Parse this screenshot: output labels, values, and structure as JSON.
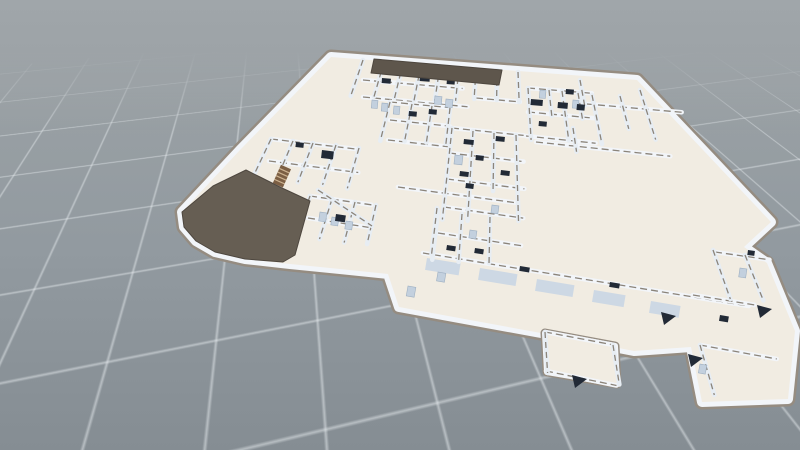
{
  "app": {
    "name": "3d-floorplan-viewer"
  },
  "viewport": {
    "width": 800,
    "height": 450
  },
  "palette": {
    "bg_top": "#a0a6aa",
    "bg_bottom": "#858d93",
    "grid_line": "rgba(232,237,240,0.5)",
    "floor": "#f1ece2",
    "wall_white": "#f2f5f9",
    "wall_white_v": "#e7edf3",
    "wall_cap": "#8b847a",
    "outline_cap": "#958c81",
    "roof_dark": "#665e53",
    "roof_strip": "#5e564c",
    "roof_edge": "#4e473f",
    "panel_recess": "#cdd8e4",
    "fixture": "#c3d0de",
    "fixture_edge": "#9fb0c2",
    "furniture": "#222a36",
    "stair": "#7c5f44",
    "stair_stripe": "#cdb391"
  },
  "scene": {
    "vp_u": [
      -1742,
      -99
    ],
    "vp_v": [
      502,
      -347
    ],
    "footprint": [
      [
        331,
        57
      ],
      [
        637,
        80
      ],
      [
        771,
        222
      ],
      [
        744,
        247
      ],
      [
        767,
        263
      ],
      [
        795,
        331
      ],
      [
        788,
        399
      ],
      [
        702,
        402
      ],
      [
        691,
        347
      ],
      [
        634,
        351
      ],
      [
        541,
        333
      ],
      [
        399,
        307
      ],
      [
        388,
        274
      ],
      [
        340,
        269
      ],
      [
        290,
        264
      ],
      [
        245,
        259
      ],
      [
        215,
        252
      ],
      [
        196,
        241
      ],
      [
        184,
        227
      ],
      [
        182,
        212
      ],
      [
        240,
        150
      ]
    ],
    "extra_floors": [
      [
        [
          545,
          333
        ],
        [
          615,
          346
        ],
        [
          617,
          384
        ],
        [
          547,
          372
        ]
      ]
    ],
    "roofs": [
      {
        "fill": "roof_dark",
        "points": [
          [
            182,
            212
          ],
          [
            184,
            227
          ],
          [
            196,
            241
          ],
          [
            215,
            252
          ],
          [
            245,
            259
          ],
          [
            283,
            262
          ],
          [
            295,
            255
          ],
          [
            310,
            201
          ],
          [
            282,
            188
          ],
          [
            260,
            177
          ],
          [
            246,
            170
          ],
          [
            213,
            186
          ]
        ]
      },
      {
        "fill": "roof_strip",
        "points": [
          [
            374,
            59
          ],
          [
            502,
            70
          ],
          [
            499,
            85
          ],
          [
            371,
            73
          ]
        ]
      }
    ],
    "walls_u": [
      [
        363,
        80,
        100
      ],
      [
        363,
        97,
        105
      ],
      [
        476,
        98,
        44
      ],
      [
        528,
        88,
        64
      ],
      [
        528,
        112,
        66
      ],
      [
        526,
        136,
        70
      ],
      [
        587,
        104,
        95
      ],
      [
        390,
        102,
        60
      ],
      [
        390,
        120,
        60
      ],
      [
        388,
        140,
        62
      ],
      [
        452,
        128,
        72
      ],
      [
        449,
        153,
        75
      ],
      [
        447,
        179,
        78
      ],
      [
        444,
        207,
        80
      ],
      [
        438,
        233,
        84
      ],
      [
        398,
        187,
        120
      ],
      [
        271,
        139,
        88
      ],
      [
        269,
        161,
        90
      ],
      [
        310,
        196,
        62
      ],
      [
        308,
        218,
        64
      ],
      [
        423,
        253,
        330
      ],
      [
        536,
        142,
        135
      ],
      [
        715,
        252,
        55
      ],
      [
        693,
        295,
        62
      ],
      [
        545,
        332,
        70
      ],
      [
        546,
        371,
        72
      ],
      [
        700,
        345,
        78
      ]
    ],
    "walls_v": [
      [
        363,
        60,
        38
      ],
      [
        384,
        62,
        36
      ],
      [
        403,
        63,
        36
      ],
      [
        421,
        65,
        36
      ],
      [
        440,
        66,
        35
      ],
      [
        459,
        68,
        33
      ],
      [
        476,
        69,
        30
      ],
      [
        497,
        70,
        30
      ],
      [
        518,
        72,
        30
      ],
      [
        528,
        88,
        52
      ],
      [
        549,
        90,
        26
      ],
      [
        562,
        91,
        50
      ],
      [
        578,
        93,
        26
      ],
      [
        592,
        95,
        50
      ],
      [
        580,
        80,
        26
      ],
      [
        620,
        96,
        34
      ],
      [
        640,
        90,
        52
      ],
      [
        573,
        128,
        24
      ],
      [
        390,
        102,
        40
      ],
      [
        412,
        104,
        38
      ],
      [
        432,
        106,
        37
      ],
      [
        450,
        108,
        36
      ],
      [
        452,
        128,
        92
      ],
      [
        473,
        131,
        90
      ],
      [
        494,
        133,
        58
      ],
      [
        516,
        135,
        86
      ],
      [
        438,
        210,
        50
      ],
      [
        462,
        214,
        48
      ],
      [
        490,
        217,
        46
      ],
      [
        271,
        139,
        42
      ],
      [
        293,
        141,
        28
      ],
      [
        313,
        143,
        42
      ],
      [
        336,
        145,
        42
      ],
      [
        359,
        148,
        42
      ],
      [
        310,
        196,
        44
      ],
      [
        332,
        199,
        42
      ],
      [
        355,
        202,
        42
      ],
      [
        376,
        205,
        40
      ],
      [
        437,
        208,
        47
      ],
      [
        713,
        250,
        52
      ],
      [
        745,
        255,
        49
      ],
      [
        545,
        332,
        41
      ],
      [
        613,
        345,
        40
      ],
      [
        700,
        345,
        52
      ]
    ],
    "walls_free": [
      [
        318,
        190,
        372,
        226
      ]
    ],
    "panels": [
      [
        427,
        258,
        34,
        12
      ],
      [
        480,
        268,
        38,
        12
      ],
      [
        537,
        279,
        38,
        12
      ],
      [
        594,
        290,
        32,
        12
      ],
      [
        651,
        301,
        30,
        12
      ]
    ],
    "fixtures": [
      [
        320,
        212,
        7,
        9
      ],
      [
        332,
        217,
        7,
        8
      ],
      [
        346,
        221,
        7,
        8
      ],
      [
        408,
        286,
        8,
        10
      ],
      [
        438,
        272,
        8,
        9
      ],
      [
        372,
        100,
        6,
        8
      ],
      [
        382,
        103,
        6,
        8
      ],
      [
        394,
        106,
        6,
        8
      ],
      [
        435,
        96,
        7,
        8
      ],
      [
        446,
        99,
        7,
        8
      ],
      [
        455,
        155,
        8,
        9
      ],
      [
        470,
        230,
        7,
        8
      ],
      [
        540,
        90,
        6,
        8
      ],
      [
        573,
        100,
        6,
        8
      ],
      [
        740,
        268,
        7,
        9
      ],
      [
        700,
        364,
        7,
        9
      ],
      [
        492,
        205,
        7,
        8
      ]
    ],
    "furniture": [
      [
        382,
        78,
        9,
        5
      ],
      [
        420,
        76,
        10,
        5
      ],
      [
        447,
        79,
        8,
        5
      ],
      [
        531,
        99,
        12,
        6
      ],
      [
        566,
        89,
        8,
        5
      ],
      [
        558,
        102,
        10,
        6
      ],
      [
        577,
        104,
        8,
        6
      ],
      [
        539,
        121,
        8,
        5
      ],
      [
        464,
        139,
        10,
        5
      ],
      [
        496,
        136,
        9,
        5
      ],
      [
        476,
        155,
        8,
        5
      ],
      [
        460,
        171,
        9,
        5
      ],
      [
        501,
        170,
        9,
        5
      ],
      [
        466,
        183,
        8,
        5
      ],
      [
        447,
        245,
        9,
        5
      ],
      [
        475,
        248,
        9,
        5
      ],
      [
        409,
        111,
        8,
        5
      ],
      [
        429,
        109,
        8,
        5
      ],
      [
        296,
        142,
        8,
        5
      ],
      [
        322,
        150,
        12,
        8
      ],
      [
        336,
        214,
        10,
        7
      ],
      [
        720,
        315,
        9,
        6
      ],
      [
        748,
        250,
        7,
        5
      ],
      [
        520,
        266,
        10,
        5
      ],
      [
        610,
        282,
        10,
        5
      ]
    ],
    "triangles": [
      [
        688,
        354
      ],
      [
        757,
        305
      ],
      [
        572,
        375
      ],
      [
        661,
        312
      ]
    ],
    "stairs": [
      {
        "x": 286,
        "y": 167,
        "w": 11,
        "len": 20,
        "a": 114
      },
      {
        "x": 260,
        "y": 196,
        "w": 12,
        "len": 22,
        "a": 116
      }
    ]
  }
}
